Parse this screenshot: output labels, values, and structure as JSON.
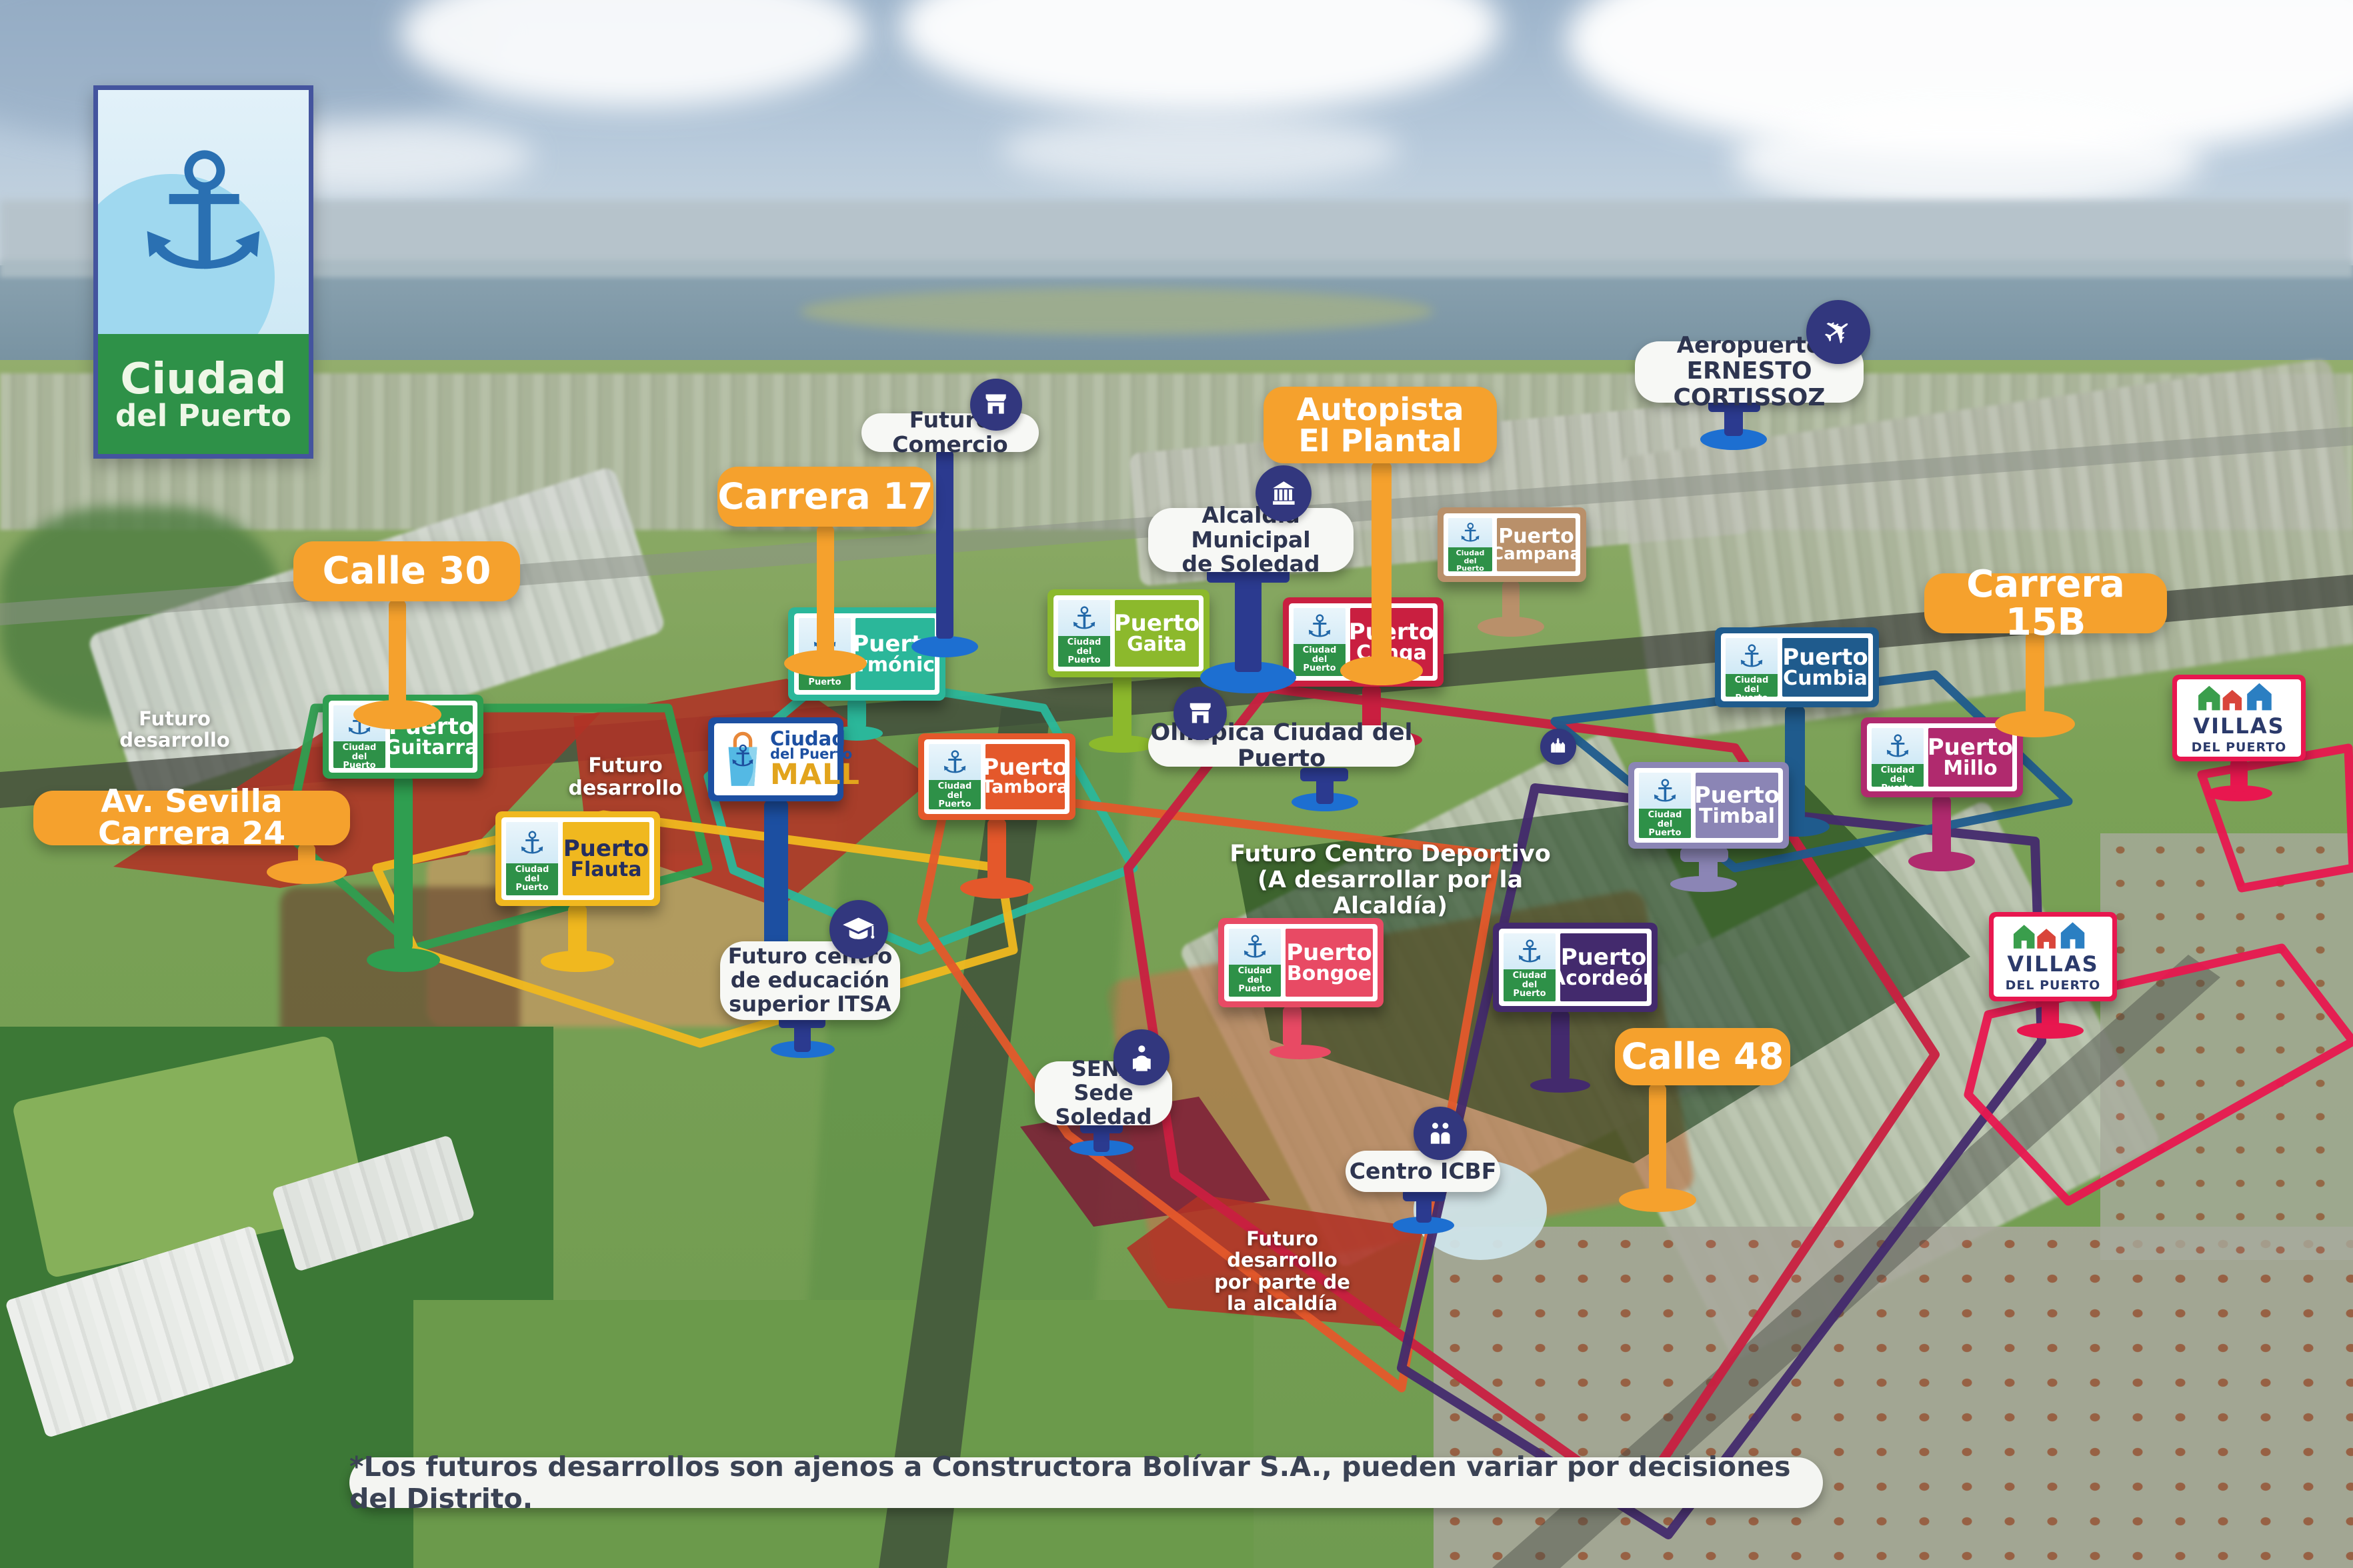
{
  "logo": {
    "line1": "Ciudad",
    "line2": "del Puerto"
  },
  "brand": {
    "small_line1": "Ciudad",
    "small_line2": "del Puerto"
  },
  "colors": {
    "orange": "#f5a12d",
    "pill_bg": "#f7f8f5",
    "pill_text": "#2e3550",
    "icon_circle": "#32377e",
    "pin_blue": "#1d6fd1",
    "stem_navy": "#2b3a8f",
    "brand_green": "#2e9148",
    "anchor_blue": "#2268a8",
    "red_zone": "#b03226",
    "dark_red_zone": "#7d1b36",
    "deportivo_zone": "#0c330f",
    "villas_pink": "#e8174f",
    "logo_border": "#44549e"
  },
  "street_labels": [
    {
      "id": "calle-30",
      "label": "Calle 30"
    },
    {
      "id": "carrera-17",
      "label": "Carrera 17"
    },
    {
      "id": "autopista-el-plantal",
      "line1": "Autopista",
      "line2": "El Plantal"
    },
    {
      "id": "carrera-15b",
      "label": "Carrera 15B"
    },
    {
      "id": "av-sevilla-carrera-24",
      "label": "Av. Sevilla Carrera 24"
    },
    {
      "id": "calle-48",
      "label": "Calle 48"
    }
  ],
  "poi_labels": [
    {
      "id": "futuro-comercio",
      "label": "Futuro Comercio",
      "icon": "store-icon"
    },
    {
      "id": "alcaldia-municipal",
      "line1": "Alcaldía Municipal",
      "line2": "de Soledad",
      "icon": "government-building-icon"
    },
    {
      "id": "aeropuerto",
      "line1": "Aeropuerto",
      "line2": "ERNESTO CORTISSOZ",
      "icon": "plane-icon"
    },
    {
      "id": "olimpica",
      "label": "Olímpica Ciudad del Puerto",
      "icon": "store-icon"
    },
    {
      "id": "itsa",
      "line1": "Futuro centro",
      "line2": "de educación",
      "line3": "superior ITSA",
      "icon": "graduation-cap-icon"
    },
    {
      "id": "sena",
      "line1": "SENA",
      "line2": "Sede Soledad",
      "icon": "reader-icon"
    },
    {
      "id": "centro-icbf",
      "label": "Centro ICBF",
      "icon": "family-icon"
    }
  ],
  "project_signs": [
    {
      "id": "puerto-guitarra",
      "line1": "Puerto",
      "line2": "Guitarra",
      "color": "#2f9e50"
    },
    {
      "id": "puerto-armonica",
      "line1": "Puerto",
      "line2": "Armónica",
      "color": "#2bb79a"
    },
    {
      "id": "puerto-gaita",
      "line1": "Puerto",
      "line2": "Gaita",
      "color": "#8cb92c"
    },
    {
      "id": "puerto-conga",
      "line1": "Puerto",
      "line2": "Conga",
      "color": "#c91f40"
    },
    {
      "id": "puerto-campana",
      "line1": "Puerto",
      "line2": "Campana",
      "color": "#b9906a"
    },
    {
      "id": "puerto-cumbia",
      "line1": "Puerto",
      "line2": "Cumbia",
      "color": "#1f5b8d"
    },
    {
      "id": "puerto-millo",
      "line1": "Puerto",
      "line2": "Millo",
      "color": "#b02a6e"
    },
    {
      "id": "puerto-timbal",
      "line1": "Puerto",
      "line2": "Timbal",
      "color": "#8b85b5"
    },
    {
      "id": "puerto-flauta",
      "line1": "Puerto",
      "line2": "Flauta",
      "color": "#f0b81f",
      "text_color": "#252e5e"
    },
    {
      "id": "puerto-tambora",
      "line1": "Puerto",
      "line2": "Tambora",
      "color": "#e4582b"
    },
    {
      "id": "puerto-bongoe",
      "line1": "Puerto",
      "line2": "Bongoe",
      "color": "#e84a64"
    },
    {
      "id": "puerto-acordeon",
      "line1": "Puerto",
      "line2": "Acordeón",
      "color": "#432a6d"
    }
  ],
  "mall_sign": {
    "line1": "Ciudad",
    "line2": "del Puerto",
    "line3": "MALL",
    "frame_color": "#1c4fa1",
    "mall_color": "#e2a41c"
  },
  "villas_signs": [
    {
      "id": "villas-del-puerto-1",
      "line1": "VILLAS",
      "line2": "DEL PUERTO"
    },
    {
      "id": "villas-del-puerto-2",
      "line1": "VILLAS",
      "line2": "DEL PUERTO"
    }
  ],
  "ground_labels": [
    {
      "id": "futuro-desarrollo-oeste",
      "line1": "Futuro",
      "line2": "desarrollo"
    },
    {
      "id": "futuro-desarrollo-centro",
      "line1": "Futuro",
      "line2": "desarrollo"
    },
    {
      "id": "futuro-centro-deportivo",
      "line1": "Futuro Centro Deportivo",
      "line2": "(A desarrollar por la Alcaldía)"
    },
    {
      "id": "futuro-desarrollo-alcaldia",
      "line1": "Futuro desarrollo",
      "line2": "por parte de",
      "line3": "la alcaldía"
    }
  ],
  "disclaimer": "*Los futuros desarrollos son ajenos a Constructora Bolívar S.A., pueden variar por decisiones del Distrito."
}
